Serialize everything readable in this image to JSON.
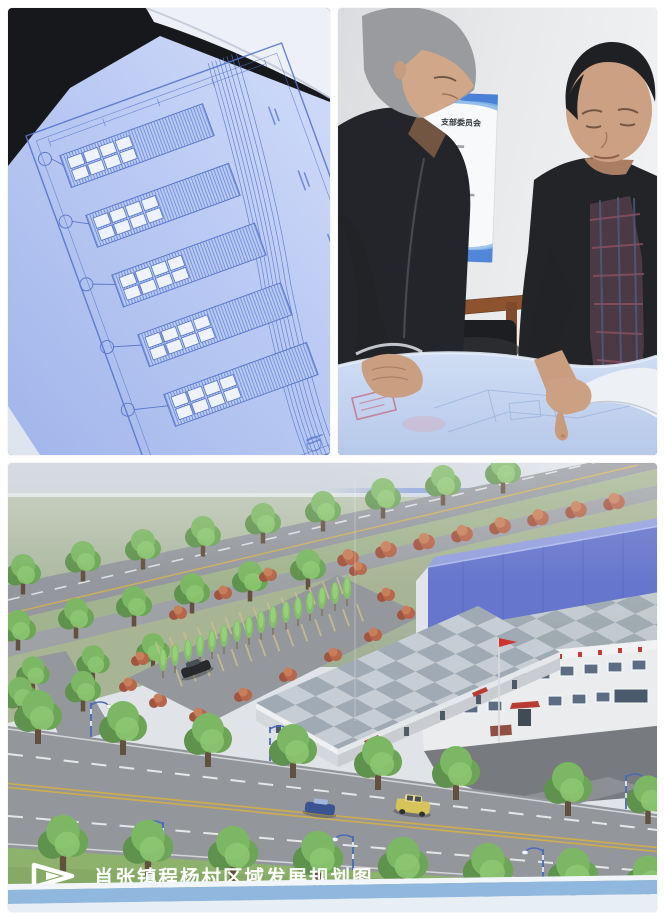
{
  "collage": {
    "photos": {
      "blueprint": {
        "name": "blueprint-closeup-photo"
      },
      "meeting": {
        "name": "officials-reviewing-blueprint-photo",
        "wall_sign_title": "支部委员会"
      },
      "plan": {
        "name": "village-development-rendering-photo",
        "caption": "肖张镇程杨村区域发展规划图"
      }
    },
    "icons": {
      "caption_arrow": "caption-arrow-icon"
    },
    "colors": {
      "blueprint_paper": "#b9c9f2",
      "blueprint_line": "#4e6fc8",
      "warehouse_roof_blue": "#5d6ec9",
      "flag_red": "#cc2822",
      "awning_red": "#b23028",
      "lawn_green": "#7da55c",
      "road_gray": "#8d9196",
      "caption_text": "#ffffff",
      "board_edge_blue": "#8ab4dc",
      "sign_wave_blue": "#2f6fd0"
    }
  }
}
